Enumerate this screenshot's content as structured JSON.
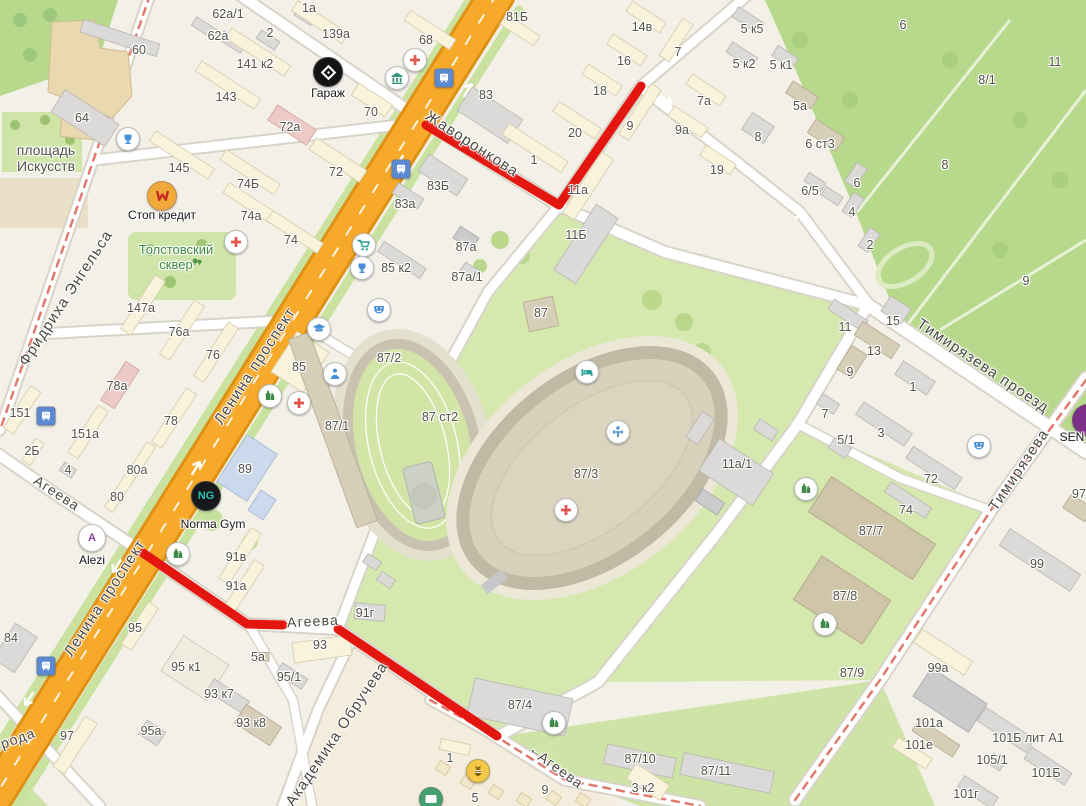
{
  "map": {
    "colors": {
      "background": "#f3f0e7",
      "park_green": "#b7d98b",
      "lawn_green": "#d5e8ae",
      "light_green": "#cde4a6",
      "main_road_orange": "#f7a92a",
      "road_casing": "#d8d4c8",
      "route_red": "#e3170f",
      "tram_red": "#df7a6d",
      "label_gray": "#57534b",
      "park_label_green": "#3f8a3f"
    },
    "route": {
      "color": "#e3170f",
      "width": 9,
      "segments": [
        [
          [
            426,
            125
          ],
          [
            559,
            205
          ],
          [
            641,
            86
          ]
        ],
        [
          [
            143,
            553
          ],
          [
            247,
            624
          ],
          [
            283,
            625
          ]
        ],
        [
          [
            338,
            629
          ],
          [
            497,
            736
          ]
        ]
      ]
    },
    "street_labels": [
      {
        "t": "Жаворонкова",
        "x": 472,
        "y": 144,
        "rot": 33,
        "fs": 15
      },
      {
        "t": "Тимирязева проезд",
        "x": 983,
        "y": 366,
        "rot": 34,
        "fs": 15
      },
      {
        "t": "Тимирязева",
        "x": 1019,
        "y": 470,
        "rot": -56,
        "fs": 15
      },
      {
        "t": "Ленина проспект",
        "x": 255,
        "y": 366,
        "rot": -57,
        "fs": 15
      },
      {
        "t": "Ленина проспект",
        "x": 105,
        "y": 598,
        "rot": -57,
        "fs": 15
      },
      {
        "t": "Фридриха Энгельса",
        "x": 66,
        "y": 298,
        "rot": -57,
        "fs": 15
      },
      {
        "t": "Академика Обручева",
        "x": 337,
        "y": 734,
        "rot": -56,
        "fs": 15
      },
      {
        "t": "Агеева",
        "x": 57,
        "y": 493,
        "rot": 33,
        "fs": 14
      },
      {
        "t": "Агеева",
        "x": 313,
        "y": 621,
        "rot": -3,
        "fs": 14
      },
      {
        "t": "Агеева",
        "x": 561,
        "y": 770,
        "rot": 36,
        "fs": 14
      },
      {
        "t": "←",
        "x": 537,
        "y": 751,
        "rot": 36,
        "fs": 14
      },
      {
        "t": "рода",
        "x": 18,
        "y": 738,
        "rot": -20,
        "fs": 14
      }
    ],
    "place_labels": [
      {
        "lines": [
          "площадь",
          "Искусств"
        ],
        "x": 46,
        "y": 158,
        "color": "#55524b",
        "fs": 14
      },
      {
        "lines": [
          "Толстовский",
          "сквер"
        ],
        "x": 176,
        "y": 258,
        "color": "#3f8a3f",
        "fs": 13
      }
    ],
    "building_labels": [
      [
        "62а/1",
        228,
        14
      ],
      [
        "62а",
        218,
        36
      ],
      [
        "1а",
        309,
        8
      ],
      [
        "2",
        270,
        33
      ],
      [
        "139а",
        336,
        34
      ],
      [
        "60",
        139,
        50
      ],
      [
        "141 к2",
        255,
        64
      ],
      [
        "143",
        226,
        97
      ],
      [
        "64",
        82,
        118
      ],
      [
        "72а",
        290,
        127
      ],
      [
        "145",
        179,
        168
      ],
      [
        "72",
        336,
        172
      ],
      [
        "74Б",
        248,
        184
      ],
      [
        "74а",
        251,
        216
      ],
      [
        "74",
        291,
        240
      ],
      [
        "68",
        426,
        40
      ],
      [
        "81Б",
        517,
        17
      ],
      [
        "83",
        486,
        95
      ],
      [
        "70",
        371,
        112
      ],
      [
        "83Б",
        438,
        186
      ],
      [
        "83а",
        405,
        204
      ],
      [
        "1",
        534,
        160
      ],
      [
        "20",
        575,
        133
      ],
      [
        "18",
        600,
        91
      ],
      [
        "16",
        624,
        61
      ],
      [
        "14в",
        642,
        27
      ],
      [
        "11а",
        578,
        190
      ],
      [
        "11Б",
        576,
        235
      ],
      [
        "9",
        630,
        126
      ],
      [
        "9а",
        682,
        130
      ],
      [
        "7",
        678,
        52
      ],
      [
        "7а",
        704,
        101
      ],
      [
        "5 к5",
        752,
        29
      ],
      [
        "5 к2",
        744,
        64
      ],
      [
        "5 к1",
        781,
        65
      ],
      [
        "5а",
        800,
        106
      ],
      [
        "8",
        758,
        137
      ],
      [
        "19",
        717,
        170
      ],
      [
        "6 ст3",
        820,
        144
      ],
      [
        "6/5",
        810,
        191
      ],
      [
        "6",
        857,
        183
      ],
      [
        "4",
        852,
        212
      ],
      [
        "2",
        870,
        245
      ],
      [
        "6",
        903,
        25
      ],
      [
        "8/1",
        987,
        80
      ],
      [
        "11",
        1055,
        62
      ],
      [
        "8",
        945,
        165
      ],
      [
        "9",
        1026,
        281
      ],
      [
        "87а",
        466,
        247
      ],
      [
        "85 к2",
        396,
        268
      ],
      [
        "87а/1",
        467,
        277
      ],
      [
        "87/2",
        389,
        358
      ],
      [
        "85",
        299,
        367
      ],
      [
        "87/1",
        337,
        426
      ],
      [
        "89",
        245,
        469
      ],
      [
        "87 ст2",
        440,
        417
      ],
      [
        "87",
        541,
        313
      ],
      [
        "87/3",
        586,
        474
      ],
      [
        "11а/1",
        737,
        464
      ],
      [
        "15",
        893,
        321
      ],
      [
        "13",
        874,
        351
      ],
      [
        "11",
        845,
        327
      ],
      [
        "9",
        850,
        372
      ],
      [
        "1",
        913,
        387
      ],
      [
        "3",
        881,
        433
      ],
      [
        "5/1",
        846,
        440
      ],
      [
        "7",
        825,
        414
      ],
      [
        "72",
        931,
        479
      ],
      [
        "74",
        906,
        510
      ],
      [
        "87/7",
        871,
        531
      ],
      [
        "87/8",
        845,
        596
      ],
      [
        "147а",
        141,
        308
      ],
      [
        "76а",
        179,
        332
      ],
      [
        "76",
        213,
        355
      ],
      [
        "78а",
        117,
        386
      ],
      [
        "78",
        171,
        421
      ],
      [
        "151",
        20,
        413
      ],
      [
        "151а",
        85,
        434
      ],
      [
        "2Б",
        32,
        451
      ],
      [
        "4",
        68,
        470
      ],
      [
        "80а",
        137,
        470
      ],
      [
        "80",
        117,
        497
      ],
      [
        "84",
        11,
        638
      ],
      [
        "95",
        135,
        628
      ],
      [
        "95 к1",
        186,
        667
      ],
      [
        "5а",
        258,
        657
      ],
      [
        "95/1",
        289,
        677
      ],
      [
        "93 к7",
        219,
        694
      ],
      [
        "93 к8",
        251,
        723
      ],
      [
        "95а",
        151,
        731
      ],
      [
        "97",
        67,
        736
      ],
      [
        "91в",
        236,
        557
      ],
      [
        "91а",
        236,
        586
      ],
      [
        "91г",
        365,
        613
      ],
      [
        "93",
        320,
        645
      ],
      [
        "87/4",
        520,
        705
      ],
      [
        "1",
        450,
        758
      ],
      [
        "5",
        475,
        798
      ],
      [
        "9",
        545,
        790
      ],
      [
        "3 к2",
        643,
        788
      ],
      [
        "87/10",
        640,
        759
      ],
      [
        "87/11",
        716,
        771
      ],
      [
        "87/9",
        852,
        673
      ],
      [
        "99а",
        938,
        668
      ],
      [
        "99",
        1037,
        564
      ],
      [
        "101а",
        929,
        723
      ],
      [
        "101е",
        919,
        745
      ],
      [
        "101Б лит А1",
        1028,
        738
      ],
      [
        "105/1",
        992,
        760
      ],
      [
        "101Б",
        1046,
        773
      ],
      [
        "101г",
        966,
        794
      ],
      [
        "97",
        1079,
        494
      ]
    ],
    "pois": [
      {
        "icon": "cross",
        "x": 415,
        "y": 60,
        "fg": "#e2574c"
      },
      {
        "icon": "cross",
        "x": 236,
        "y": 242,
        "fg": "#e2574c"
      },
      {
        "icon": "cross",
        "x": 299,
        "y": 403,
        "fg": "#e2574c"
      },
      {
        "icon": "cross",
        "x": 566,
        "y": 510,
        "fg": "#e2574c"
      },
      {
        "icon": "bank",
        "x": 397,
        "y": 78,
        "fg": "#35967d"
      },
      {
        "icon": "cart",
        "x": 364,
        "y": 245,
        "fg": "#2aa198"
      },
      {
        "icon": "fountain",
        "x": 128,
        "y": 139,
        "fg": "#4a90d9"
      },
      {
        "icon": "fountain",
        "x": 362,
        "y": 268,
        "fg": "#4a90d9"
      },
      {
        "icon": "masks",
        "x": 379,
        "y": 310,
        "fg": "#4a90d9"
      },
      {
        "icon": "masks",
        "x": 979,
        "y": 446,
        "fg": "#4a90d9"
      },
      {
        "icon": "cap",
        "x": 319,
        "y": 329,
        "fg": "#4a90d9"
      },
      {
        "icon": "person",
        "x": 335,
        "y": 374,
        "fg": "#4a90d9"
      },
      {
        "icon": "bed",
        "x": 587,
        "y": 372,
        "fg": "#2aa198"
      },
      {
        "icon": "sport",
        "x": 618,
        "y": 432,
        "fg": "#4a90d9"
      },
      {
        "icon": "bottle",
        "x": 270,
        "y": 396,
        "fg": "#3e8948"
      },
      {
        "icon": "bottle",
        "x": 178,
        "y": 554,
        "fg": "#3e8948"
      },
      {
        "icon": "bottle",
        "x": 806,
        "y": 489,
        "fg": "#3e8948"
      },
      {
        "icon": "bottle",
        "x": 825,
        "y": 624,
        "fg": "#3e8948"
      },
      {
        "icon": "bottle",
        "x": 554,
        "y": 723,
        "fg": "#3e8948"
      },
      {
        "icon": "mail",
        "x": 431,
        "y": 799,
        "fg": "#ffffff",
        "bg": "#43a06f"
      },
      {
        "icon": "bee",
        "x": 478,
        "y": 771,
        "fg": "#7a5b00",
        "bg": "#f4c945"
      },
      {
        "icon": "bus",
        "x": 444,
        "y": 78,
        "shape": "square",
        "bg": "#5b8ad2",
        "fg": "#ffffff",
        "size": 17
      },
      {
        "icon": "bus",
        "x": 401,
        "y": 169,
        "shape": "square",
        "bg": "#5b8ad2",
        "fg": "#ffffff",
        "size": 17
      },
      {
        "icon": "bus",
        "x": 46,
        "y": 416,
        "shape": "square",
        "bg": "#5b8ad2",
        "fg": "#ffffff",
        "size": 17
      },
      {
        "icon": "bus",
        "x": 46,
        "y": 666,
        "shape": "square",
        "bg": "#5b8ad2",
        "fg": "#ffffff",
        "size": 17
      },
      {
        "icon": "trees",
        "x": 197,
        "y": 262,
        "naked": true,
        "fg": "#4e9a44",
        "size": 18
      },
      {
        "icon": "diamond",
        "x": 328,
        "y": 72,
        "bg": "#141414",
        "fg": "#ffffff",
        "size": 28,
        "label": "Гараж",
        "lx": 328,
        "ly": 86
      },
      {
        "icon": "stopw",
        "x": 162,
        "y": 196,
        "bg": "#f2a93b",
        "fg": "#c22a1e",
        "size": 28,
        "label": "Стоп кредит",
        "lx": 162,
        "ly": 208
      },
      {
        "text": "NG",
        "x": 206,
        "y": 496,
        "bg": "#17181c",
        "fg": "#2bbfae",
        "size": 28,
        "label": "Norma Gym",
        "lx": 213,
        "ly": 517
      },
      {
        "text": "A",
        "x": 92,
        "y": 538,
        "bg": "#ffffff",
        "fg": "#8a3f9e",
        "size": 26,
        "label": "Alezi",
        "lx": 92,
        "ly": 553
      },
      {
        "text": "",
        "x": 1088,
        "y": 420,
        "bg": "#7b2f86",
        "fg": "#ffffff",
        "size": 30,
        "label": "SEN",
        "lx": 1072,
        "ly": 430
      }
    ],
    "icon_paths": {
      "cross": "<path d='M6.6 3h2.8v3.6H13v2.8H9.4V13H6.6V9.4H3V6.6h3.6z'/>",
      "bank": "<path d='M8 2.5L13.5 6v1H2.5V6zM3.5 7.8h1.8V12H3.5zM7.1 7.8h1.8V12H7.1zM10.7 7.8h1.8V12h-1.8zM2.8 12.6h10.4v1.4H2.8z'/>",
      "cart": "<path d='M2.5 3.5h2l.5 1.5h8l-1.4 4.5H6.2L5 5z' fill='none' stroke='currentColor' stroke-width='1.4'/><circle cx='6.6' cy='12.3' r='1.2'/><circle cx='10.8' cy='12.3' r='1.2'/>",
      "fountain": "<path d='M4.5 3.5h7v2.8a3.5 3.5 0 0 1-7 0zM6.8 9.8h2.4v1.6H6.8zM5.4 11.6h5.2V13H5.4z'/>",
      "masks": "<path d='M3.2 4h9.6v3a4.8 4.4 0 0 1-9.6 0z'/><circle cx='5.9' cy='6' r='.9' fill='#fff'/><circle cx='10.1' cy='6' r='.9' fill='#fff'/><path d='M5.6 8.6q2.4 2 4.8 0' stroke='#fff' stroke-width='1.2' fill='none'/>",
      "cap": "<path d='M8 3l6.5 2.7L8 8.4 1.5 5.7z'/><path d='M4.4 7.2v2.6c0 1 7.2 1 7.2 0V7.2L8 8.7z'/>",
      "person": "<circle cx='8' cy='4.6' r='2'/><path d='M3.8 13a4.2 4.2 0 0 1 8.4 0z'/>",
      "bed": "<path d='M2.5 5v7h1.6v-1.6h7.8V12h1.6V8.6a2.6 2.6 0 0 0-2.6-2.6H7.2v2.8H4.1V5z'/><circle cx='5.6' cy='7.2' r='1.2'/>",
      "sport": "<circle cx='8' cy='4' r='1.7'/><path d='M3.5 7.2h9v1.6h-9zM7.1 8.8h1.8V13H7.1zM3 6.2h1.4v3.6H3zM11.6 6.2H13v3.6h-1.4z'/>",
      "bottle": "<path d='M5.2 2.8h1.8v1.8l1.4 1V12H3.8V5.6l1.4-1z'/><path d='M9.4 5h1.5v1.4l1.3.9V12H8.9V7.9l.5-.4z'/>",
      "mail": "<rect x='2.5' y='4' width='11' height='8' rx='1.2'/><path d='M3 4.8L8 8.8l5-4' fill='none' stroke='#fff' stroke-width='1.2'/>",
      "bee": "<ellipse cx='8' cy='9' rx='3.2' ry='4'/><path d='M4.8 7.4h6.4M4.8 9.4h6.4' stroke='#fff' stroke-width='1' fill='none'/><path d='M5.5 3.5L8 5.5l2.5-2' fill='none' stroke='currentColor' stroke-width='1.2'/>",
      "bus": "<rect x='3' y='2.8' width='10' height='8.4' rx='1.4'/><rect x='4.2' y='11.6' width='2' height='1.6'/><rect x='9.8' y='11.6' width='2' height='1.6'/><rect x='4.4' y='4.4' width='7.2' height='2.8' fill='#cfe0ff'/>",
      "trees": "<circle cx='5' cy='6' r='3'/><rect x='4.4' y='8' width='1.2' height='3'/><circle cx='10.5' cy='7' r='2.4'/><rect x='10' y='8.8' width='1' height='2.6'/>",
      "diamond": "<path d='M8 3.2l4.8 4.8L8 12.8 3.2 8z' fill='none' stroke='#fff' stroke-width='1.6'/><path d='M6.9 8L8 9.1 9.1 8 8 6.9z' fill='#fff'/>",
      "stopw": "<path d='M4 4.5l1.5 6 2.5-4 2.5 4 1.5-6' fill='none' stroke='currentColor' stroke-width='1.8' stroke-linecap='round' stroke-linejoin='round'/>"
    }
  }
}
